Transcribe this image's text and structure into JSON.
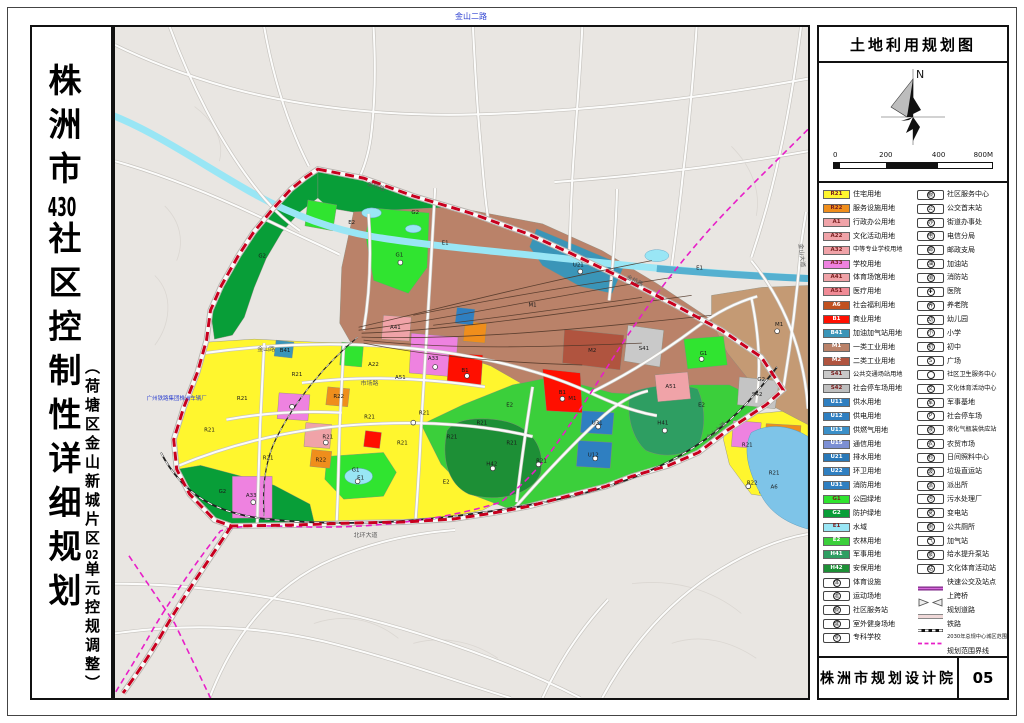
{
  "titles": {
    "m1": "株洲市",
    "m2": "430",
    "m3": "社区控制性详细规划",
    "s1": "（荷塘区金山新城片区",
    "s2": "02",
    "s3": "单元控规调整）"
  },
  "right_panel": {
    "map_title": "土地利用规划图",
    "north_label": "N",
    "scale_ticks": [
      "0",
      "200",
      "400",
      "800M"
    ],
    "agency": "株洲市规划设计院",
    "sheet_no": "05"
  },
  "legend": {
    "left": [
      {
        "code": "R21",
        "color": "#FFF62E",
        "label": "住宅用地"
      },
      {
        "code": "R22",
        "color": "#EF8E1C",
        "label": "服务设施用地"
      },
      {
        "code": "A1",
        "color": "#F0A3A8",
        "label": "行政办公用地"
      },
      {
        "code": "A22",
        "color": "#F0A3A8",
        "label": "文化活动用地"
      },
      {
        "code": "A32",
        "color": "#F0A3A8",
        "label": "中等专业学校用地"
      },
      {
        "code": "A33",
        "color": "#EE82E0",
        "label": "学校用地"
      },
      {
        "code": "A41",
        "color": "#F0A3A8",
        "label": "体育场馆用地"
      },
      {
        "code": "A51",
        "color": "#F08B96",
        "label": "医疗用地"
      },
      {
        "code": "A6",
        "color": "#C1511F",
        "label": "社会福利用地"
      },
      {
        "code": "B1",
        "color": "#FF0F00",
        "label": "商业用地"
      },
      {
        "code": "B41",
        "color": "#3A95B8",
        "label": "加油加气站用地"
      },
      {
        "code": "M1",
        "color": "#BA8269",
        "label": "一类工业用地"
      },
      {
        "code": "M2",
        "color": "#B0543F",
        "label": "二类工业用地"
      },
      {
        "code": "S41",
        "color": "#C9C9C9",
        "label": "公共交通场站用地"
      },
      {
        "code": "S42",
        "color": "#BFBFBF",
        "label": "社会停车场用地"
      },
      {
        "code": "U11",
        "color": "#2F7FC1",
        "label": "供水用地"
      },
      {
        "code": "U12",
        "color": "#2F7FC1",
        "label": "供电用地"
      },
      {
        "code": "U13",
        "color": "#3A8FC8",
        "label": "供燃气用地"
      },
      {
        "code": "U15",
        "color": "#7C8FD4",
        "label": "通信用地"
      },
      {
        "code": "U21",
        "color": "#2878B8",
        "label": "排水用地"
      },
      {
        "code": "U22",
        "color": "#2F7FC1",
        "label": "环卫用地"
      },
      {
        "code": "U31",
        "color": "#2F7FC1",
        "label": "消防用地"
      },
      {
        "code": "G1",
        "color": "#30E430",
        "label": "公园绿地"
      },
      {
        "code": "G2",
        "color": "#089E38",
        "label": "防护绿地"
      },
      {
        "code": "E1",
        "color": "#99E6F5",
        "label": "水域"
      },
      {
        "code": "E2",
        "color": "#3BCF3B",
        "label": "农林用地"
      },
      {
        "code": "H41",
        "color": "#2E9E62",
        "label": "军事用地"
      },
      {
        "code": "H42",
        "color": "#1D8F36",
        "label": "安保用地"
      },
      {
        "icon": "体",
        "label": "体育设施"
      },
      {
        "icon": "运",
        "label": "运动场地"
      },
      {
        "icon": "服",
        "label": "社区服务站"
      },
      {
        "icon": "健",
        "label": "室外健身场地"
      },
      {
        "icon": "专",
        "label": "专科学校"
      }
    ],
    "right": [
      {
        "icon": "服",
        "label": "社区服务中心"
      },
      {
        "icon": "公",
        "label": "公交首末站"
      },
      {
        "icon": "办",
        "label": "街道办事处"
      },
      {
        "icon": "电",
        "label": "电信分局"
      },
      {
        "icon": "邮",
        "label": "邮政支局"
      },
      {
        "icon": "油",
        "label": "加油站"
      },
      {
        "icon": "消",
        "label": "消防站"
      },
      {
        "icon": "✚",
        "label": "医院"
      },
      {
        "icon": "养",
        "label": "养老院"
      },
      {
        "icon": "幼",
        "label": "幼儿园"
      },
      {
        "icon": "小",
        "label": "小学"
      },
      {
        "icon": "初",
        "label": "初中"
      },
      {
        "icon": "S",
        "label": "广场"
      },
      {
        "icon": "",
        "label": "社区卫生服务中心"
      },
      {
        "icon": "文",
        "label": "文化体育活动中心"
      },
      {
        "icon": "军",
        "label": "军事基地"
      },
      {
        "icon": "P",
        "label": "社会停车场"
      },
      {
        "icon": "液",
        "label": "液化气瓶装供应站"
      },
      {
        "icon": "农",
        "label": "农贸市场"
      },
      {
        "icon": "料",
        "label": "日间照料中心"
      },
      {
        "icon": "圾",
        "label": "垃圾直运站"
      },
      {
        "icon": "派",
        "label": "派出所"
      },
      {
        "icon": "污",
        "label": "污水处理厂"
      },
      {
        "icon": "变",
        "label": "变电站"
      },
      {
        "icon": "厕",
        "label": "公共厕所"
      },
      {
        "icon": "气",
        "label": "加气站"
      },
      {
        "icon": "泵",
        "label": "给水提升泵站"
      },
      {
        "icon": "站",
        "label": "文化体育活动站"
      },
      {
        "sym": "brt",
        "label": "快速公交及站点"
      },
      {
        "sym": "bridge",
        "label": "上跨桥"
      },
      {
        "sym": "road",
        "label": "规划道路"
      },
      {
        "sym": "rail",
        "label": "铁路"
      },
      {
        "sym": "line2030",
        "label": "2030年总规中心城区范围界线"
      },
      {
        "sym": "boundary",
        "label": "规划范围界线"
      }
    ]
  },
  "map": {
    "margin_label": "金山二路",
    "labels": [
      {
        "t": "金桥路",
        "x": 262,
        "y": 162,
        "c": "rd",
        "r": 18
      },
      {
        "t": "金桥路",
        "x": 522,
        "y": 257,
        "c": "rd",
        "r": 26
      },
      {
        "t": "北环大道",
        "x": 252,
        "y": 513,
        "c": "rd"
      },
      {
        "t": "金山大道",
        "x": 606,
        "y": 408,
        "c": "rd",
        "r": -41
      },
      {
        "t": "金山大道",
        "x": 689,
        "y": 230,
        "c": "rd",
        "r": 84
      },
      {
        "t": "市场路",
        "x": 256,
        "y": 360,
        "c": "rd"
      },
      {
        "t": "金山路",
        "x": 152,
        "y": 326,
        "c": "rd"
      },
      {
        "t": "广州铁路集团株洲车辆厂",
        "x": 62,
        "y": 375,
        "c": "bl"
      },
      {
        "t": "G2",
        "x": 302,
        "y": 188,
        "c": "zc"
      },
      {
        "t": "G2",
        "x": 650,
        "y": 356,
        "c": "zc"
      },
      {
        "t": "G2",
        "x": 108,
        "y": 469,
        "c": "zc"
      },
      {
        "t": "G2",
        "x": 148,
        "y": 232,
        "c": "zc"
      },
      {
        "t": "E1",
        "x": 332,
        "y": 219,
        "c": "zc"
      },
      {
        "t": "E1",
        "x": 588,
        "y": 244,
        "c": "zc"
      },
      {
        "t": "E1",
        "x": 247,
        "y": 455,
        "c": "zc"
      },
      {
        "t": "E2",
        "x": 238,
        "y": 198,
        "c": "zc"
      },
      {
        "t": "E2",
        "x": 397,
        "y": 382,
        "c": "zc"
      },
      {
        "t": "E2",
        "x": 590,
        "y": 382,
        "c": "zc"
      },
      {
        "t": "E2",
        "x": 333,
        "y": 459,
        "c": "zc"
      },
      {
        "t": "U21",
        "x": 466,
        "y": 241,
        "c": "zc"
      },
      {
        "t": "M1",
        "x": 420,
        "y": 281,
        "c": "zc"
      },
      {
        "t": "M1",
        "x": 668,
        "y": 301,
        "c": "zc"
      },
      {
        "t": "M1",
        "x": 460,
        "y": 375,
        "c": "zc"
      },
      {
        "t": "M2",
        "x": 480,
        "y": 327,
        "c": "zc"
      },
      {
        "t": "S41",
        "x": 532,
        "y": 325,
        "c": "zc"
      },
      {
        "t": "S42",
        "x": 646,
        "y": 371,
        "c": "zc"
      },
      {
        "t": "G1",
        "x": 286,
        "y": 231,
        "c": "zc"
      },
      {
        "t": "G1",
        "x": 242,
        "y": 447,
        "c": "zc"
      },
      {
        "t": "G1",
        "x": 592,
        "y": 330,
        "c": "zc"
      },
      {
        "t": "H41",
        "x": 551,
        "y": 400,
        "c": "zc"
      },
      {
        "t": "H42",
        "x": 379,
        "y": 441,
        "c": "zc"
      },
      {
        "t": "U31",
        "x": 485,
        "y": 400,
        "c": "zc"
      },
      {
        "t": "U12",
        "x": 481,
        "y": 432,
        "c": "zc"
      },
      {
        "t": "B1",
        "x": 352,
        "y": 347,
        "c": "zc"
      },
      {
        "t": "B1",
        "x": 450,
        "y": 369,
        "c": "zc"
      },
      {
        "t": "B41",
        "x": 171,
        "y": 327,
        "c": "zc"
      },
      {
        "t": "R21",
        "x": 95,
        "y": 407,
        "c": "zc"
      },
      {
        "t": "R21",
        "x": 128,
        "y": 375,
        "c": "zc"
      },
      {
        "t": "R21",
        "x": 154,
        "y": 435,
        "c": "zc"
      },
      {
        "t": "R21",
        "x": 183,
        "y": 351,
        "c": "zc"
      },
      {
        "t": "R21",
        "x": 214,
        "y": 414,
        "c": "zc"
      },
      {
        "t": "R21",
        "x": 256,
        "y": 394,
        "c": "zc"
      },
      {
        "t": "R21",
        "x": 289,
        "y": 420,
        "c": "zc"
      },
      {
        "t": "R21",
        "x": 311,
        "y": 390,
        "c": "zc"
      },
      {
        "t": "R21",
        "x": 339,
        "y": 414,
        "c": "zc"
      },
      {
        "t": "R21",
        "x": 369,
        "y": 400,
        "c": "zc"
      },
      {
        "t": "R21",
        "x": 399,
        "y": 420,
        "c": "zc"
      },
      {
        "t": "R21",
        "x": 429,
        "y": 438,
        "c": "zc"
      },
      {
        "t": "R21",
        "x": 636,
        "y": 422,
        "c": "zc"
      },
      {
        "t": "R21",
        "x": 663,
        "y": 450,
        "c": "zc"
      },
      {
        "t": "R22",
        "x": 207,
        "y": 437,
        "c": "zc"
      },
      {
        "t": "R22",
        "x": 225,
        "y": 373,
        "c": "zc"
      },
      {
        "t": "R22",
        "x": 641,
        "y": 460,
        "c": "zc"
      },
      {
        "t": "A33",
        "x": 137,
        "y": 473,
        "c": "zc"
      },
      {
        "t": "A33",
        "x": 320,
        "y": 335,
        "c": "zc"
      },
      {
        "t": "A51",
        "x": 559,
        "y": 363,
        "c": "zc"
      },
      {
        "t": "A51",
        "x": 287,
        "y": 354,
        "c": "zc"
      },
      {
        "t": "A41",
        "x": 282,
        "y": 304,
        "c": "zc"
      },
      {
        "t": "A6",
        "x": 663,
        "y": 464,
        "c": "zc"
      },
      {
        "t": "A22",
        "x": 260,
        "y": 341,
        "c": "zc"
      }
    ]
  }
}
